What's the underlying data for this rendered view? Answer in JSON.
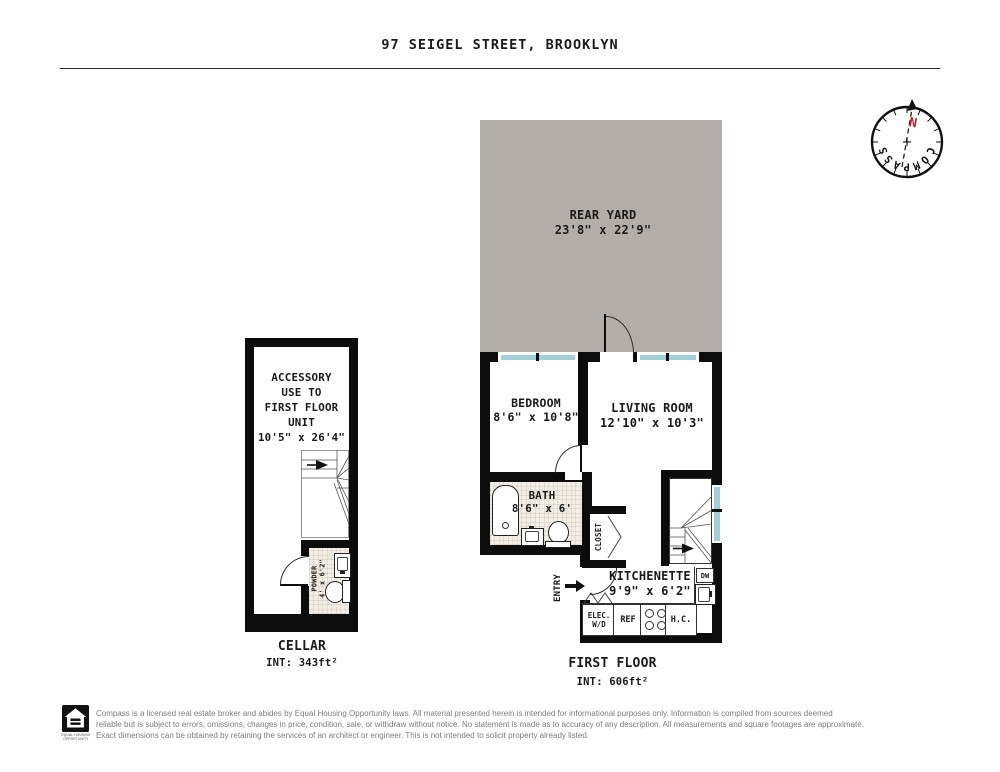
{
  "header": {
    "title": "97 SEIGEL STREET, BROOKLYN"
  },
  "compass": {
    "north": "N",
    "letters": [
      "C",
      "O",
      "M",
      "P",
      "A",
      "S",
      "S"
    ]
  },
  "rear_yard": {
    "name": "REAR YARD",
    "dims": "23'8\" x 22'9\""
  },
  "first_floor": {
    "title": "FIRST FLOOR",
    "area": "INT: 606ft²",
    "bedroom": {
      "name": "BEDROOM",
      "dims": "8'6\" x 10'8\""
    },
    "living_room": {
      "name": "LIVING ROOM",
      "dims": "12'10\" x 10'3\""
    },
    "bath": {
      "name": "BATH",
      "dims": "8'6\" x 6'"
    },
    "kitchenette": {
      "name": "KITCHENETTE",
      "dims": "9'9\" x 6'2\""
    },
    "closet": {
      "name": "CLOSET"
    },
    "entry": {
      "name": "ENTRY"
    },
    "appliances": {
      "elec_line1": "ELEC.",
      "elec_line2": "W/D",
      "ref": "REF",
      "hc": "H.C.",
      "dw": "DW"
    }
  },
  "cellar": {
    "title": "CELLAR",
    "area": "INT: 343ft²",
    "note_lines": [
      "ACCESSORY",
      "USE TO",
      "FIRST FLOOR",
      "UNIT",
      "10'5\" x 26'4\""
    ],
    "powder": {
      "name": "POWDER",
      "dims": "4' x 6'2\""
    }
  },
  "footer": {
    "logo_caption": "EQUAL HOUSING OPPORTUNITY",
    "lines": [
      "Compass is a licensed real estate broker and abides by Equal Housing Opportunity laws. All material presented herein is intended for informational purposes only. Information is compiled from sources deemed",
      "reliable but is subject to errors, omissions, changes in price, condition, sale, or withdraw without notice. No statement is made as to accuracy of any description. All measurements and square footages are approximate.",
      "Exact dimensions can be obtained by retaining the services of an architect or engineer. This is not intended to solicit property already listed."
    ]
  },
  "colors": {
    "wall": "#0c0c0c",
    "yard": "#b4aeab",
    "window": "#9fd0d8",
    "tile": "#f3efe6",
    "north": "#c42127",
    "disclaimer": "#7c7c7c"
  }
}
